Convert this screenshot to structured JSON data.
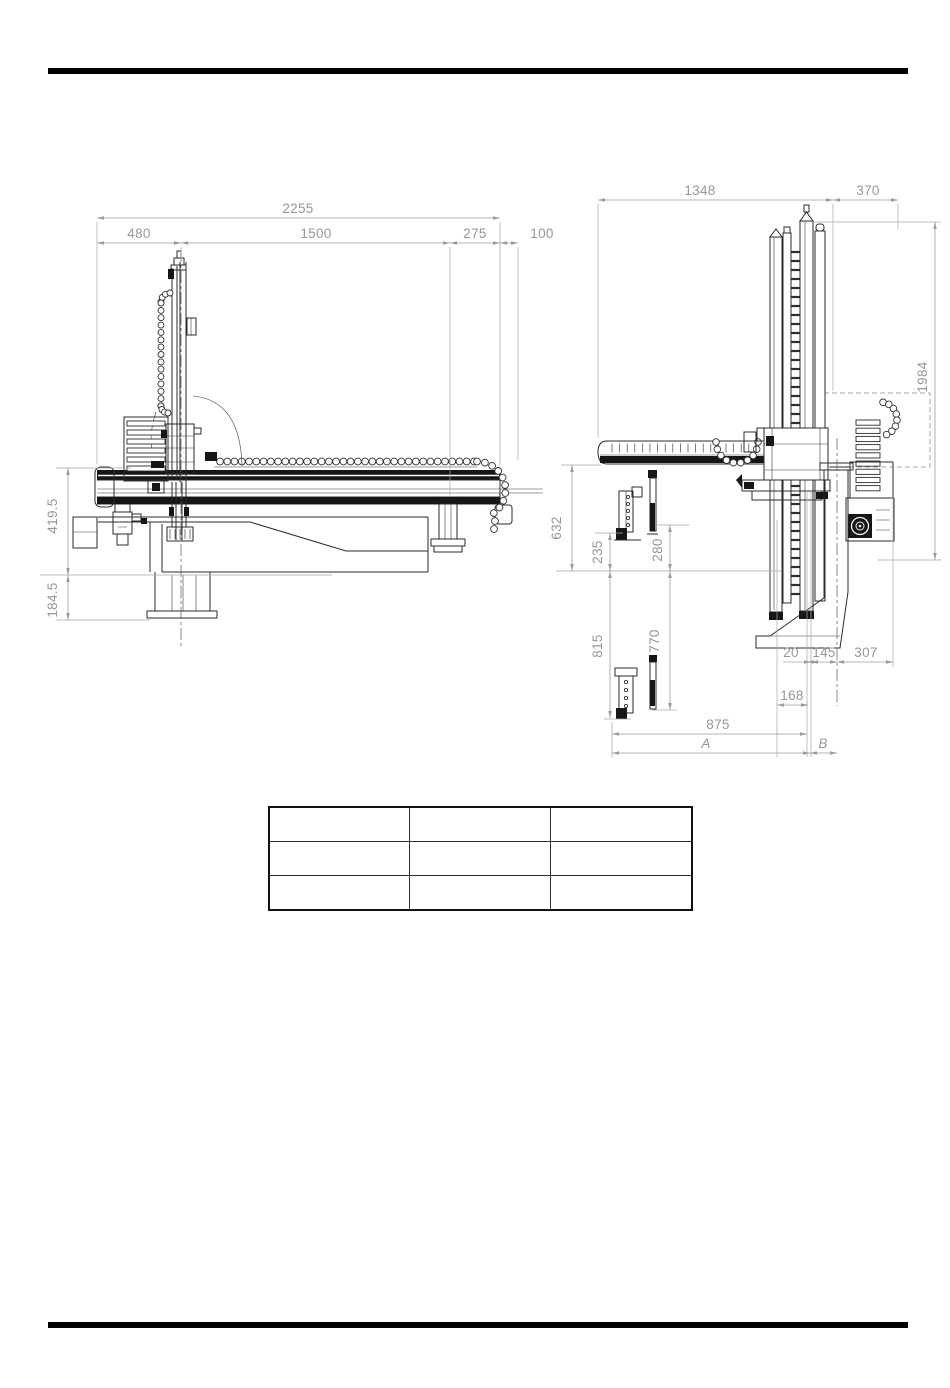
{
  "page": {
    "background": "#ffffff",
    "top_rule_color": "#000000",
    "bottom_rule_color": "#000000"
  },
  "colors": {
    "dimension_lines": "#9b9b9b",
    "drawing_lines": "#2b2b2b",
    "dark_fill": "#161616",
    "centerline": "#5a5a5a"
  },
  "side_view": {
    "dims": {
      "total_width": "2255",
      "seg_back": "480",
      "seg_stroke": "1500",
      "seg_front": "275",
      "seg_end": "100",
      "beam_height": "419.5",
      "base_height": "184.5"
    }
  },
  "front_view": {
    "dims": {
      "traverse_span": "1348",
      "side_offset": "370",
      "total_height": "1984",
      "beam_clearance": "632",
      "upper_grip_inner": "235",
      "upper_grip_outer": "280",
      "lower_grip_inner": "815",
      "lower_grip_outer": "770",
      "d20": "20",
      "d145": "145",
      "d307": "307",
      "d168": "168",
      "d875": "875",
      "stroke_a": "A",
      "stroke_b": "B"
    }
  },
  "table": {
    "rows": [
      [
        "",
        "",
        ""
      ],
      [
        "",
        "",
        ""
      ],
      [
        "",
        "",
        ""
      ]
    ]
  }
}
